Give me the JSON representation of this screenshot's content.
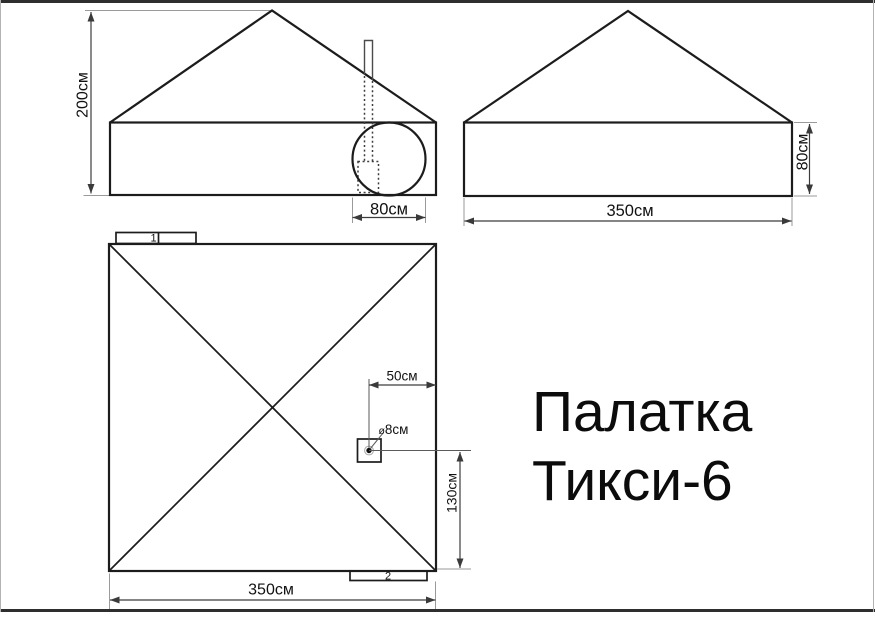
{
  "title": {
    "line1": "Палатка",
    "line2": "Тикси-6"
  },
  "front_view": {
    "height_label": "200см",
    "entrance_width_label": "80см"
  },
  "side_view": {
    "height_label": "80см",
    "width_label": "350см"
  },
  "plan_view": {
    "flap_top_label": "1",
    "flap_bottom_label": "2",
    "stove_offset_right_label": "50см",
    "stove_hole_symbol": "ø",
    "stove_hole_label": "8см",
    "stove_offset_bottom_label": "130см",
    "width_label": "350см"
  },
  "colors": {
    "background": "#ffffff",
    "outline": "#1c1c1c",
    "dimension": "#3c3c3c",
    "extension": "#9a9a9a",
    "text": "#111111"
  }
}
